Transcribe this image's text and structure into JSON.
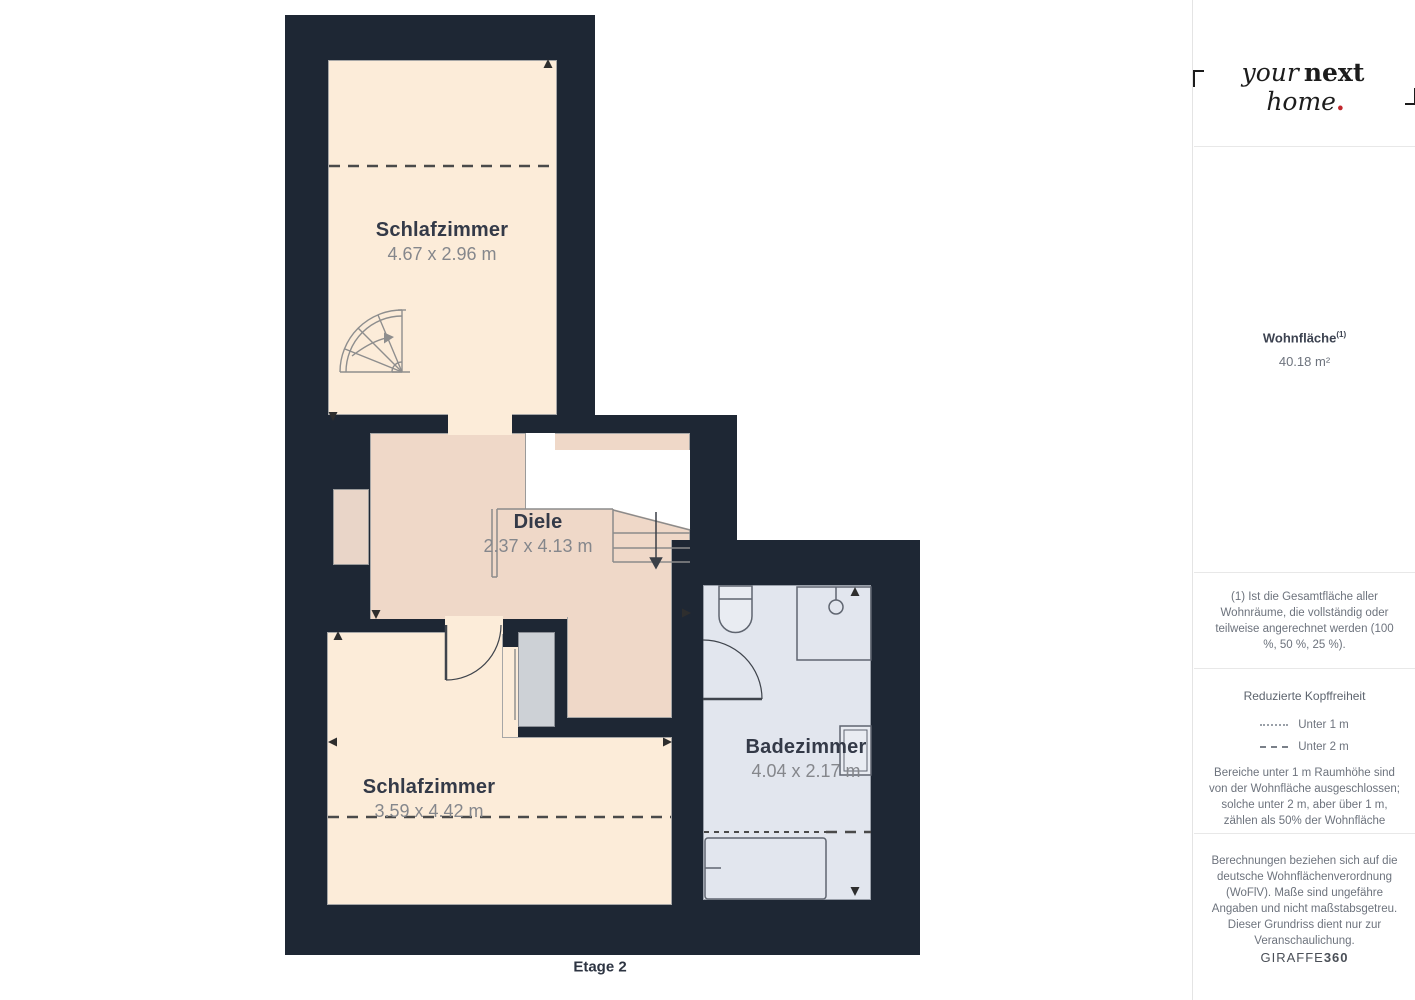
{
  "floor_plan": {
    "level_label": "Etage 2",
    "rooms": [
      {
        "id": "schlafzimmer-1",
        "name": "Schlafzimmer",
        "dimensions": "4.67 x 2.96 m"
      },
      {
        "id": "diele",
        "name": "Diele",
        "dimensions": "2.37 x 4.13 m"
      },
      {
        "id": "schlafzimmer-2",
        "name": "Schlafzimmer",
        "dimensions": "3.59 x 4.42 m"
      },
      {
        "id": "badezimmer",
        "name": "Badezimmer",
        "dimensions": "4.04 x 2.17 m"
      }
    ],
    "colors": {
      "wall": "#1e2734",
      "bedroom_floor": "#fcecd9",
      "hallway_floor": "#efd8c8",
      "bathroom_floor": "#e2e6ee",
      "shaft_gray": "#cdd1d6",
      "stairwell": "#ffffff"
    }
  },
  "sidebar": {
    "logo": {
      "word1": "your",
      "word2": "next",
      "word3": "home",
      "dot": ".",
      "dot_color": "#c1272d"
    },
    "area": {
      "label": "Wohnfläche",
      "footnote_marker": "(1)",
      "value": "40.18 m²"
    },
    "footnote_text": "(1) Ist die Gesamtfläche aller Wohnräume, die vollständig oder teilweise angerechnet werden (100 %, 50 %, 25 %).",
    "headroom": {
      "title": "Reduzierte Kopffreiheit",
      "legend": [
        {
          "style": "dotted",
          "label": "Unter 1 m"
        },
        {
          "style": "dashed",
          "label": "Unter 2 m"
        }
      ],
      "note": "Bereiche unter 1 m Raumhöhe sind von der Wohnfläche ausgeschlossen; solche unter 2 m, aber über 1 m, zählen als 50% der Wohnfläche"
    },
    "disclaimer": "Berechnungen beziehen sich auf die deutsche Wohnflächenverordnung (WoFlV). Maße sind ungefähre Angaben und nicht maßstabsgetreu. Dieser Grundriss dient nur zur Veranschaulichung.",
    "brand": {
      "name": "GIRAFFE",
      "suffix": "360"
    }
  }
}
